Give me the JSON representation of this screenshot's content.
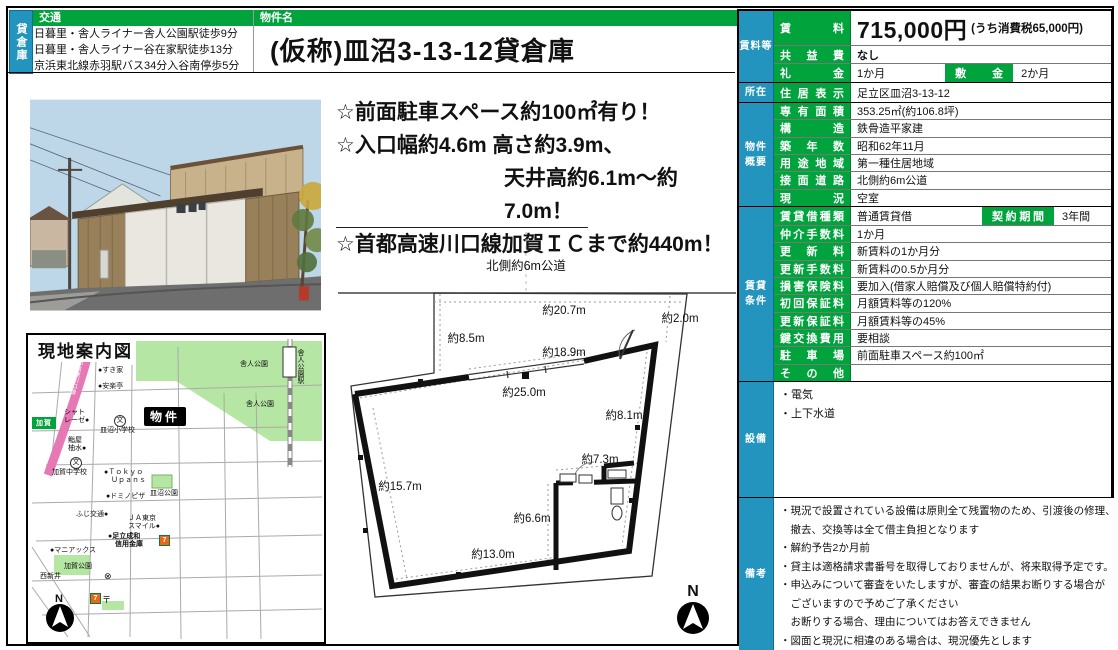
{
  "sheet": {
    "side_tab": "貸倉庫",
    "transport": {
      "header": "交通",
      "lines": "日暮里・舎人ライナー舎人公園駅徒歩9分\n日暮里・舎人ライナー谷在家駅徒歩13分\n京浜東北線赤羽駅バス34分入谷南停歩5分"
    },
    "property_name": {
      "header": "物件名",
      "value": "(仮称)皿沼3-13-12貸倉庫"
    },
    "highlights": {
      "line1": "☆前面駐車スペース約100㎡有り！",
      "line2": "☆入口幅約4.6m 高さ約3.9m、",
      "line3": "天井高約6.1m～約7.0m！",
      "line4": "☆首都高速川口線加賀ＩＣまで約440m！"
    }
  },
  "table": {
    "rent": {
      "section": "賃料等",
      "rent_label": "賃料",
      "rent_value": "715,000円",
      "rent_tax_note": "(うち消費税65,000円)",
      "kyoekihi_label": "共益費",
      "kyoekihi_value": "なし",
      "reikin_label": "礼金",
      "reikin_value": "1か月",
      "shikikin_label": "敷金",
      "shikikin_value": "2か月"
    },
    "location": {
      "section": "所在",
      "label": "住居表示",
      "value": "足立区皿沼3-13-12"
    },
    "overview": {
      "section": "物件\n概要",
      "rows": [
        {
          "label": "専有面積",
          "value": "353.25㎡(約106.8坪)"
        },
        {
          "label": "構造",
          "value": "鉄骨造平家建"
        },
        {
          "label": "築年数",
          "value": "昭和62年11月"
        },
        {
          "label": "用途地域",
          "value": "第一種住居地域"
        },
        {
          "label": "接面道路",
          "value": "北側約6m公道"
        },
        {
          "label": "現況",
          "value": "空室"
        }
      ]
    },
    "terms": {
      "section": "賃貸\n条件",
      "contract_label": "契約期間",
      "contract_value": "3年間",
      "rows": [
        {
          "label": "賃貸借種類",
          "value": "普通賃貸借"
        },
        {
          "label": "仲介手数料",
          "value": "1か月"
        },
        {
          "label": "更新料",
          "value": "新賃料の1か月分"
        },
        {
          "label": "更新手数料",
          "value": "新賃料の0.5か月分"
        },
        {
          "label": "損害保険料",
          "value": "要加入(借家人賠償及び個人賠償特約付)"
        },
        {
          "label": "初回保証料",
          "value": "月額賃料等の120%"
        },
        {
          "label": "更新保証料",
          "value": "月額賃料等の45%"
        },
        {
          "label": "鍵交換費用",
          "value": "要相談"
        },
        {
          "label": "駐車場",
          "value": "前面駐車スペース約100㎡"
        },
        {
          "label": "その他",
          "value": ""
        }
      ]
    },
    "facilities": {
      "section": "設備",
      "lines": "・電気\n・上下水道"
    },
    "remarks": {
      "section": "備考",
      "lines": "・現況で設置されている設備は原則全て残置物のため、引渡後の修理、\n　撤去、交換等は全て借主負担となります\n・解約予告2か月前\n・貸主は適格請求書番号を取得しておりませんが、将来取得予定です。\n・申込みについて審査をいたしますが、審査の結果お断りする場合が\n　ございますので予めご了承ください\n　お断りする場合、理由についてはお答えできません\n・図面と現況に相違のある場合は、現況優先とします"
    }
  },
  "map": {
    "title": "現地案内図",
    "labels": {
      "sukiya": "●すき家",
      "anrakutei": "●安楽亭",
      "chateraise": "シャト\nレーゼ●",
      "saranuma_es": "皿沼小学校",
      "school_symbol": "文",
      "bukken": "物件",
      "sushi": "鮨屋\n柚水●",
      "kaga_jhs": "加賀中学校",
      "tokyo_upans": "●Ｔｏｋｙｏ\n　Ｕｐａｎｓ",
      "saranuma_park": "皿沼公園",
      "dominos": "●ドミノピザ",
      "fuji": "ふじ交通●",
      "ja_tokyo": "ＪＡ東京\nスマイル●",
      "adachi_bank": "●足立成和\n　信用金庫",
      "maniacs": "●マニアックス",
      "kaga_park": "加賀公園",
      "nishiarai": "西新井",
      "toneri_park1": "舎人公園",
      "toneri_park2": "舎人公園",
      "toneri_station": "舎人公園駅",
      "kaga_ic": "加賀",
      "highway": "首都高速川口線",
      "seven": "7",
      "kouban": "⊗",
      "post": "〒",
      "north": "N"
    }
  },
  "plan": {
    "road_label": "北側約6m公道",
    "north": "N",
    "dims": {
      "top": "約20.7m",
      "top_right": "約2.0m",
      "left_setback": "約8.5m",
      "entrance": "約18.9m",
      "front": "約25.0m",
      "right": "約8.1m",
      "room_top": "約7.3m",
      "room_left": "約6.6m",
      "bottom": "約13.0m",
      "left": "約15.7m"
    }
  },
  "colors": {
    "green": "#00a33c",
    "blue": "#2394be",
    "highway_pink": "#e678b6",
    "park_green": "#b6e6a4"
  }
}
